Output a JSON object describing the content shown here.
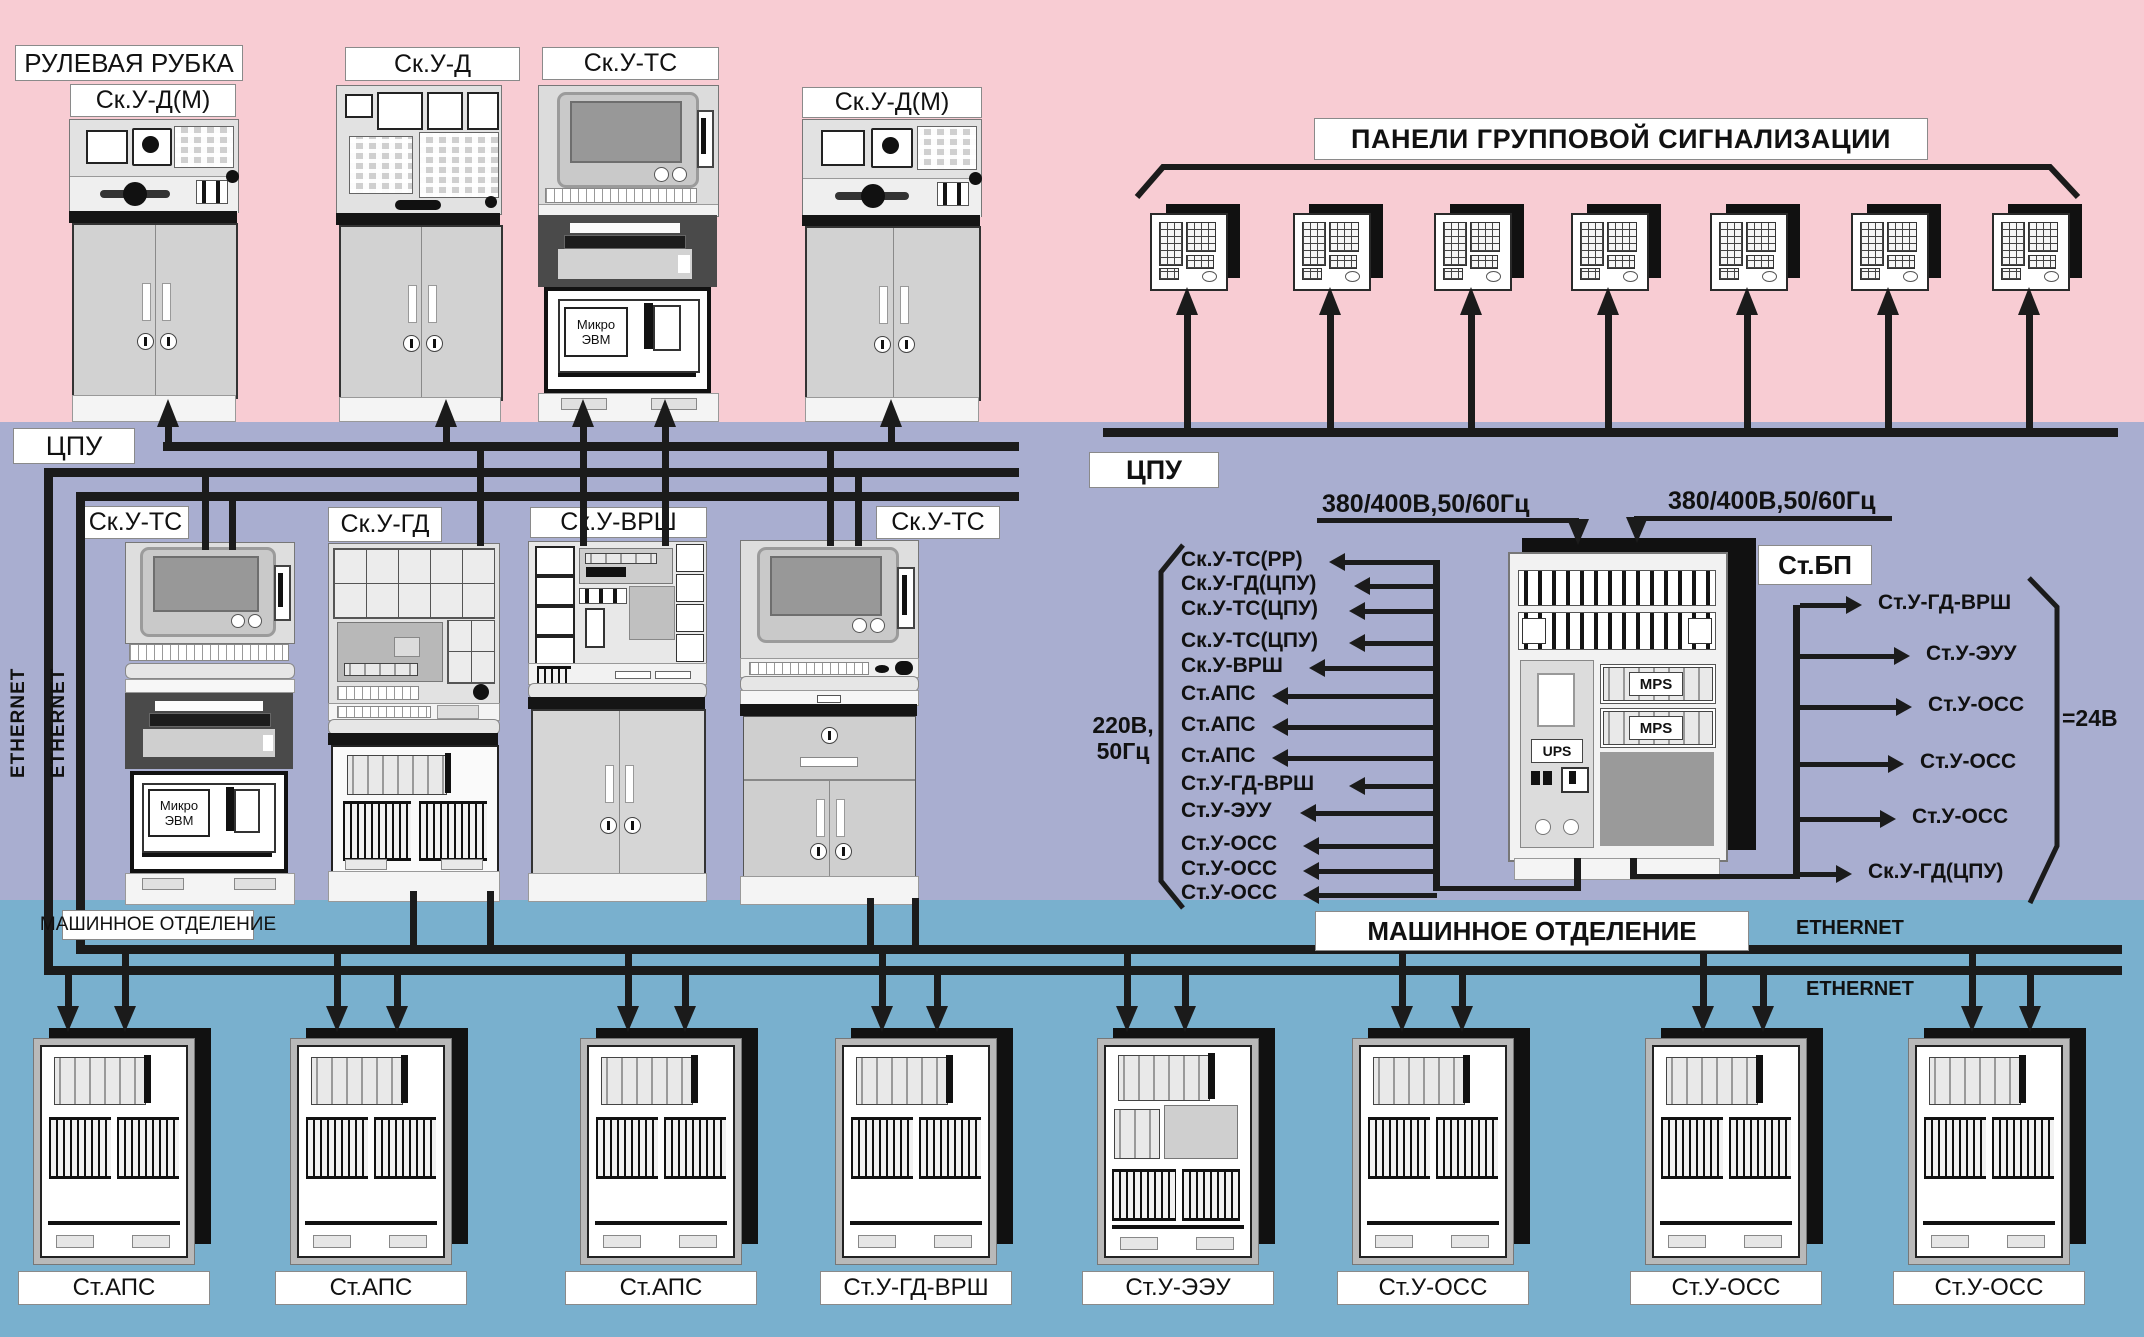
{
  "colors": {
    "wheelhouse_bg": "#f8ccd3",
    "cpu_bg": "#a9aed0",
    "engine_bg": "#79b0ce",
    "line": "#1b1b1b"
  },
  "wheelhouse": {
    "label": "РУЛЕВАЯ РУБКА",
    "consoles": [
      {
        "label": "Ск.У-Д(М)"
      },
      {
        "label": "Ск.У-Д"
      },
      {
        "label": "Ск.У-ТС"
      },
      {
        "label": "Ск.У-Д(М)"
      }
    ],
    "alarm_title": "ПАНЕЛИ ГРУППОВОЙ СИГНАЛИЗАЦИИ",
    "alarm_panel_count": 7
  },
  "micro_evm": {
    "line1": "Микро",
    "line2": "ЭВМ"
  },
  "cpu": {
    "label_left": "ЦПУ",
    "label_right": "ЦПУ",
    "ethernet": [
      "ETHERNET",
      "ETHERNET"
    ],
    "consoles": [
      {
        "label": "Ск.У-ТС"
      },
      {
        "label": "Ск.У-ГД"
      },
      {
        "label": "Ск.У-ВРШ"
      },
      {
        "label": "Ск.У-ТС"
      }
    ]
  },
  "power": {
    "feed_left": "380/400В,50/60Гц",
    "feed_right": "380/400В,50/60Гц",
    "cabinet_label": "Ст.БП",
    "ups_label": "UPS",
    "mps_labels": [
      "MPS",
      "MPS"
    ],
    "ac_voltage": [
      "220В,",
      "50Гц"
    ],
    "ac_outputs": [
      "Ск.У-ТС(РР)",
      "Ск.У-ГД(ЦПУ)",
      "Ск.У-ТС(ЦПУ)",
      "Ск.У-ТС(ЦПУ)",
      "Ск.У-ВРШ",
      "Ст.АПС",
      "Ст.АПС",
      "Ст.АПС",
      "Ст.У-ГД-ВРШ",
      "Ст.У-ЭУУ",
      "Ст.У-ОСС",
      "Ст.У-ОСС",
      "Ст.У-ОСС"
    ],
    "dc_voltage": "=24В",
    "dc_outputs": [
      "Ст.У-ГД-ВРШ",
      "Ст.У-ЭУУ",
      "Ст.У-ОСС",
      "Ст.У-ОСС",
      "Ст.У-ОСС",
      "Ск.У-ГД(ЦПУ)"
    ]
  },
  "engine_room": {
    "label_small": "МАШИННОЕ ОТДЕЛЕНИЕ",
    "label_big": "МАШИННОЕ ОТДЕЛЕНИЕ",
    "ethernet": [
      "ETHERNET",
      "ETHERNET"
    ],
    "cabinets": [
      "Ст.АПС",
      "Ст.АПС",
      "Ст.АПС",
      "Ст.У-ГД-ВРШ",
      "Ст.У-ЭЭУ",
      "Ст.У-ОСС",
      "Ст.У-ОСС",
      "Ст.У-ОСС"
    ]
  }
}
